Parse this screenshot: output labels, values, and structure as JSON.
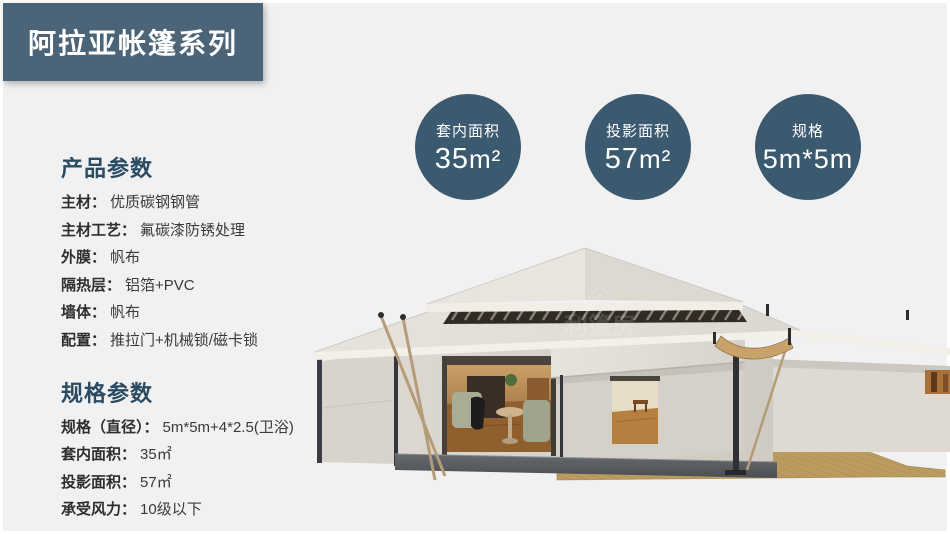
{
  "page": {
    "background": "#f1f1f2",
    "accent": "#4b6477",
    "badge_color": "#3b5a70"
  },
  "banner": {
    "title": "阿拉亚帐篷系列"
  },
  "badges": [
    {
      "label": "套内面积",
      "value": "35",
      "unit": "m²"
    },
    {
      "label": "投影面积",
      "value": "57",
      "unit": "m²"
    },
    {
      "label": "规格",
      "value": "5m*5m",
      "unit": ""
    }
  ],
  "product_params": {
    "heading": "产品参数",
    "rows": [
      {
        "label": "主材：",
        "value": "优质碳钢钢管"
      },
      {
        "label": "主材工艺：",
        "value": "氟碳漆防锈处理"
      },
      {
        "label": "外膜：",
        "value": "帆布"
      },
      {
        "label": "隔热层：",
        "value": "铝箔+PVC"
      },
      {
        "label": "墙体：",
        "value": "帆布"
      },
      {
        "label": "配置：",
        "value": "推拉门+机械锁/磁卡锁"
      }
    ]
  },
  "spec_params": {
    "heading": "规格参数",
    "rows": [
      {
        "label": "规格（直径）：",
        "value": "5m*5m+4*2.5(卫浴)"
      },
      {
        "label": "套内面积：",
        "value": "35㎡"
      },
      {
        "label": "投影面积：",
        "value": "57㎡"
      },
      {
        "label": "承受风力：",
        "value": "10级以下"
      }
    ]
  },
  "tent_image": {
    "watermark_cn": "利篷房",
    "watermark_en": "LI TENT"
  }
}
